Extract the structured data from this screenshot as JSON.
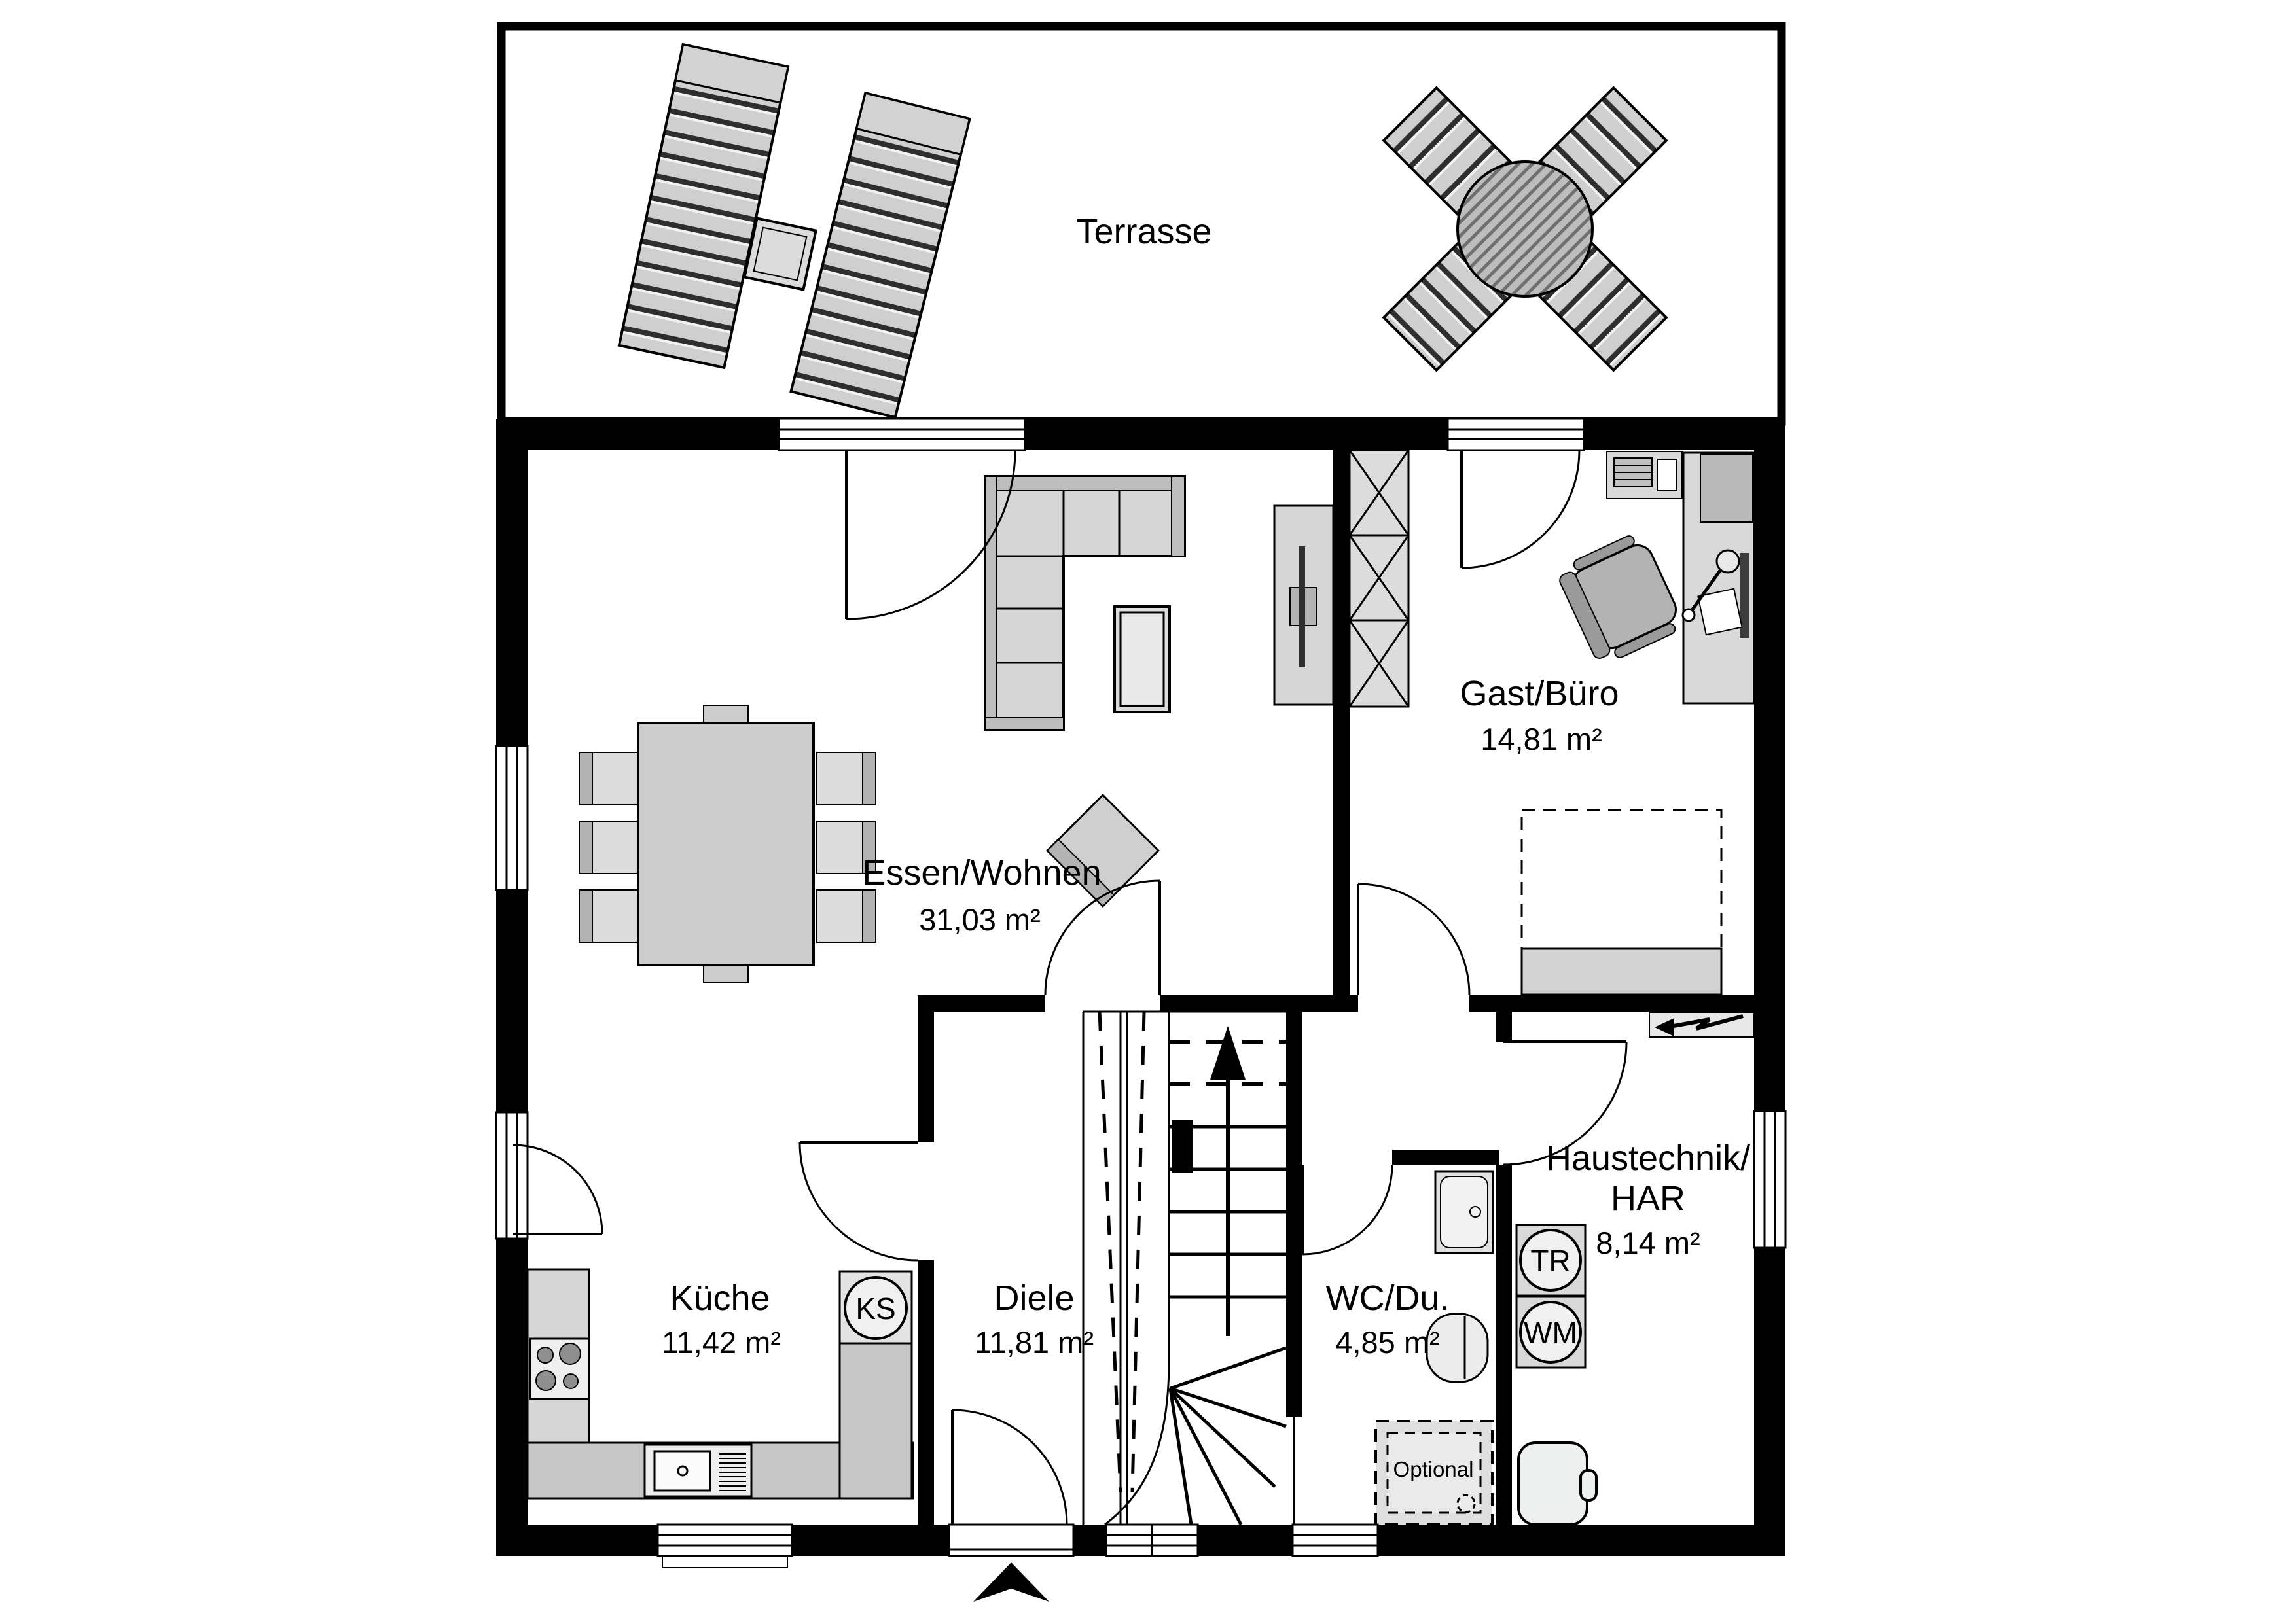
{
  "plan": {
    "terrace": {
      "label": "Terrasse"
    },
    "rooms": [
      {
        "name": "Essen/Wohnen",
        "area": "31,03 m²"
      },
      {
        "name": "Gast/Büro",
        "area": "14,81 m²"
      },
      {
        "name": "Küche",
        "area": "11,42 m²"
      },
      {
        "name": "Diele",
        "area": "11,81 m²"
      },
      {
        "name": "WC/Du.",
        "area": "4,85 m²"
      },
      {
        "name_line1": "Haustechnik/",
        "name_line2": "HAR",
        "area": "8,14 m²"
      }
    ],
    "appliances": {
      "fridge": "KS",
      "dryer": "TR",
      "washing_machine": "WM"
    },
    "notes": {
      "optional": "Optional"
    },
    "colors": {
      "wall": "#000000",
      "floor": "#ffffff",
      "furniture_light": "#d6d6d6",
      "furniture_mid": "#c6c6c6",
      "furniture_dark": "#b3b3b3"
    }
  }
}
